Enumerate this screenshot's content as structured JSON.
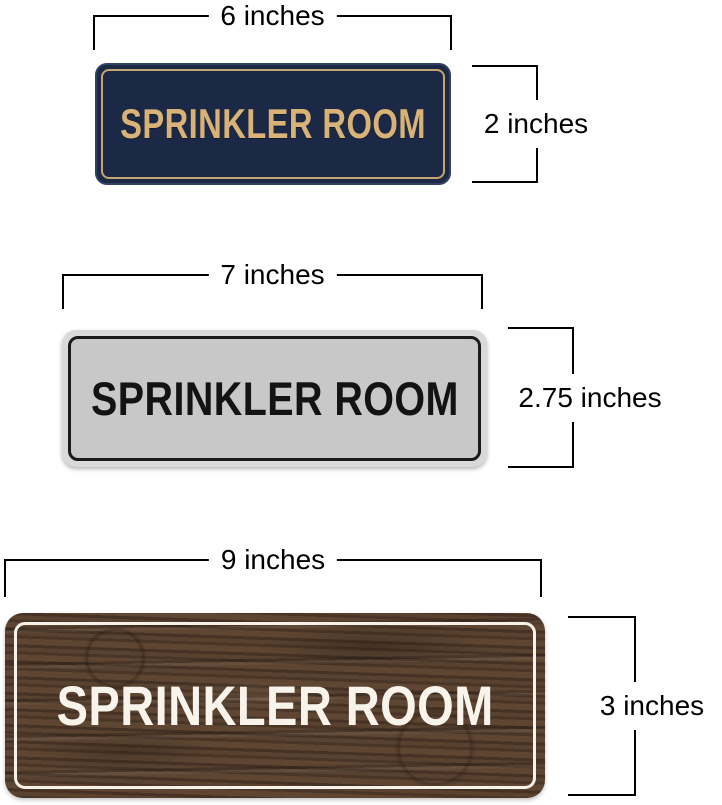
{
  "page": {
    "background": "#ffffff",
    "annotation_color": "#000000"
  },
  "signs": [
    {
      "name": "navy-gold-sign",
      "label": "SPRINKLER ROOM",
      "width_label": "6 inches",
      "height_label": "2 inches",
      "colors": {
        "background": "#1b2946",
        "border": "#c7a46a",
        "text": "#d9b277"
      }
    },
    {
      "name": "silver-black-sign",
      "label": "SPRINKLER ROOM",
      "width_label": "7 inches",
      "height_label": "2.75 inches",
      "colors": {
        "rim": "#d9d9d9",
        "background": "#c8c8c8",
        "border": "#1a1a1a",
        "text": "#131313"
      }
    },
    {
      "name": "walnut-wood-sign",
      "label": "SPRINKLER ROOM",
      "width_label": "9 inches",
      "height_label": "3 inches",
      "colors": {
        "background": "#56402f",
        "border": "#f6f2e9",
        "text": "#f8f4ec"
      }
    }
  ]
}
